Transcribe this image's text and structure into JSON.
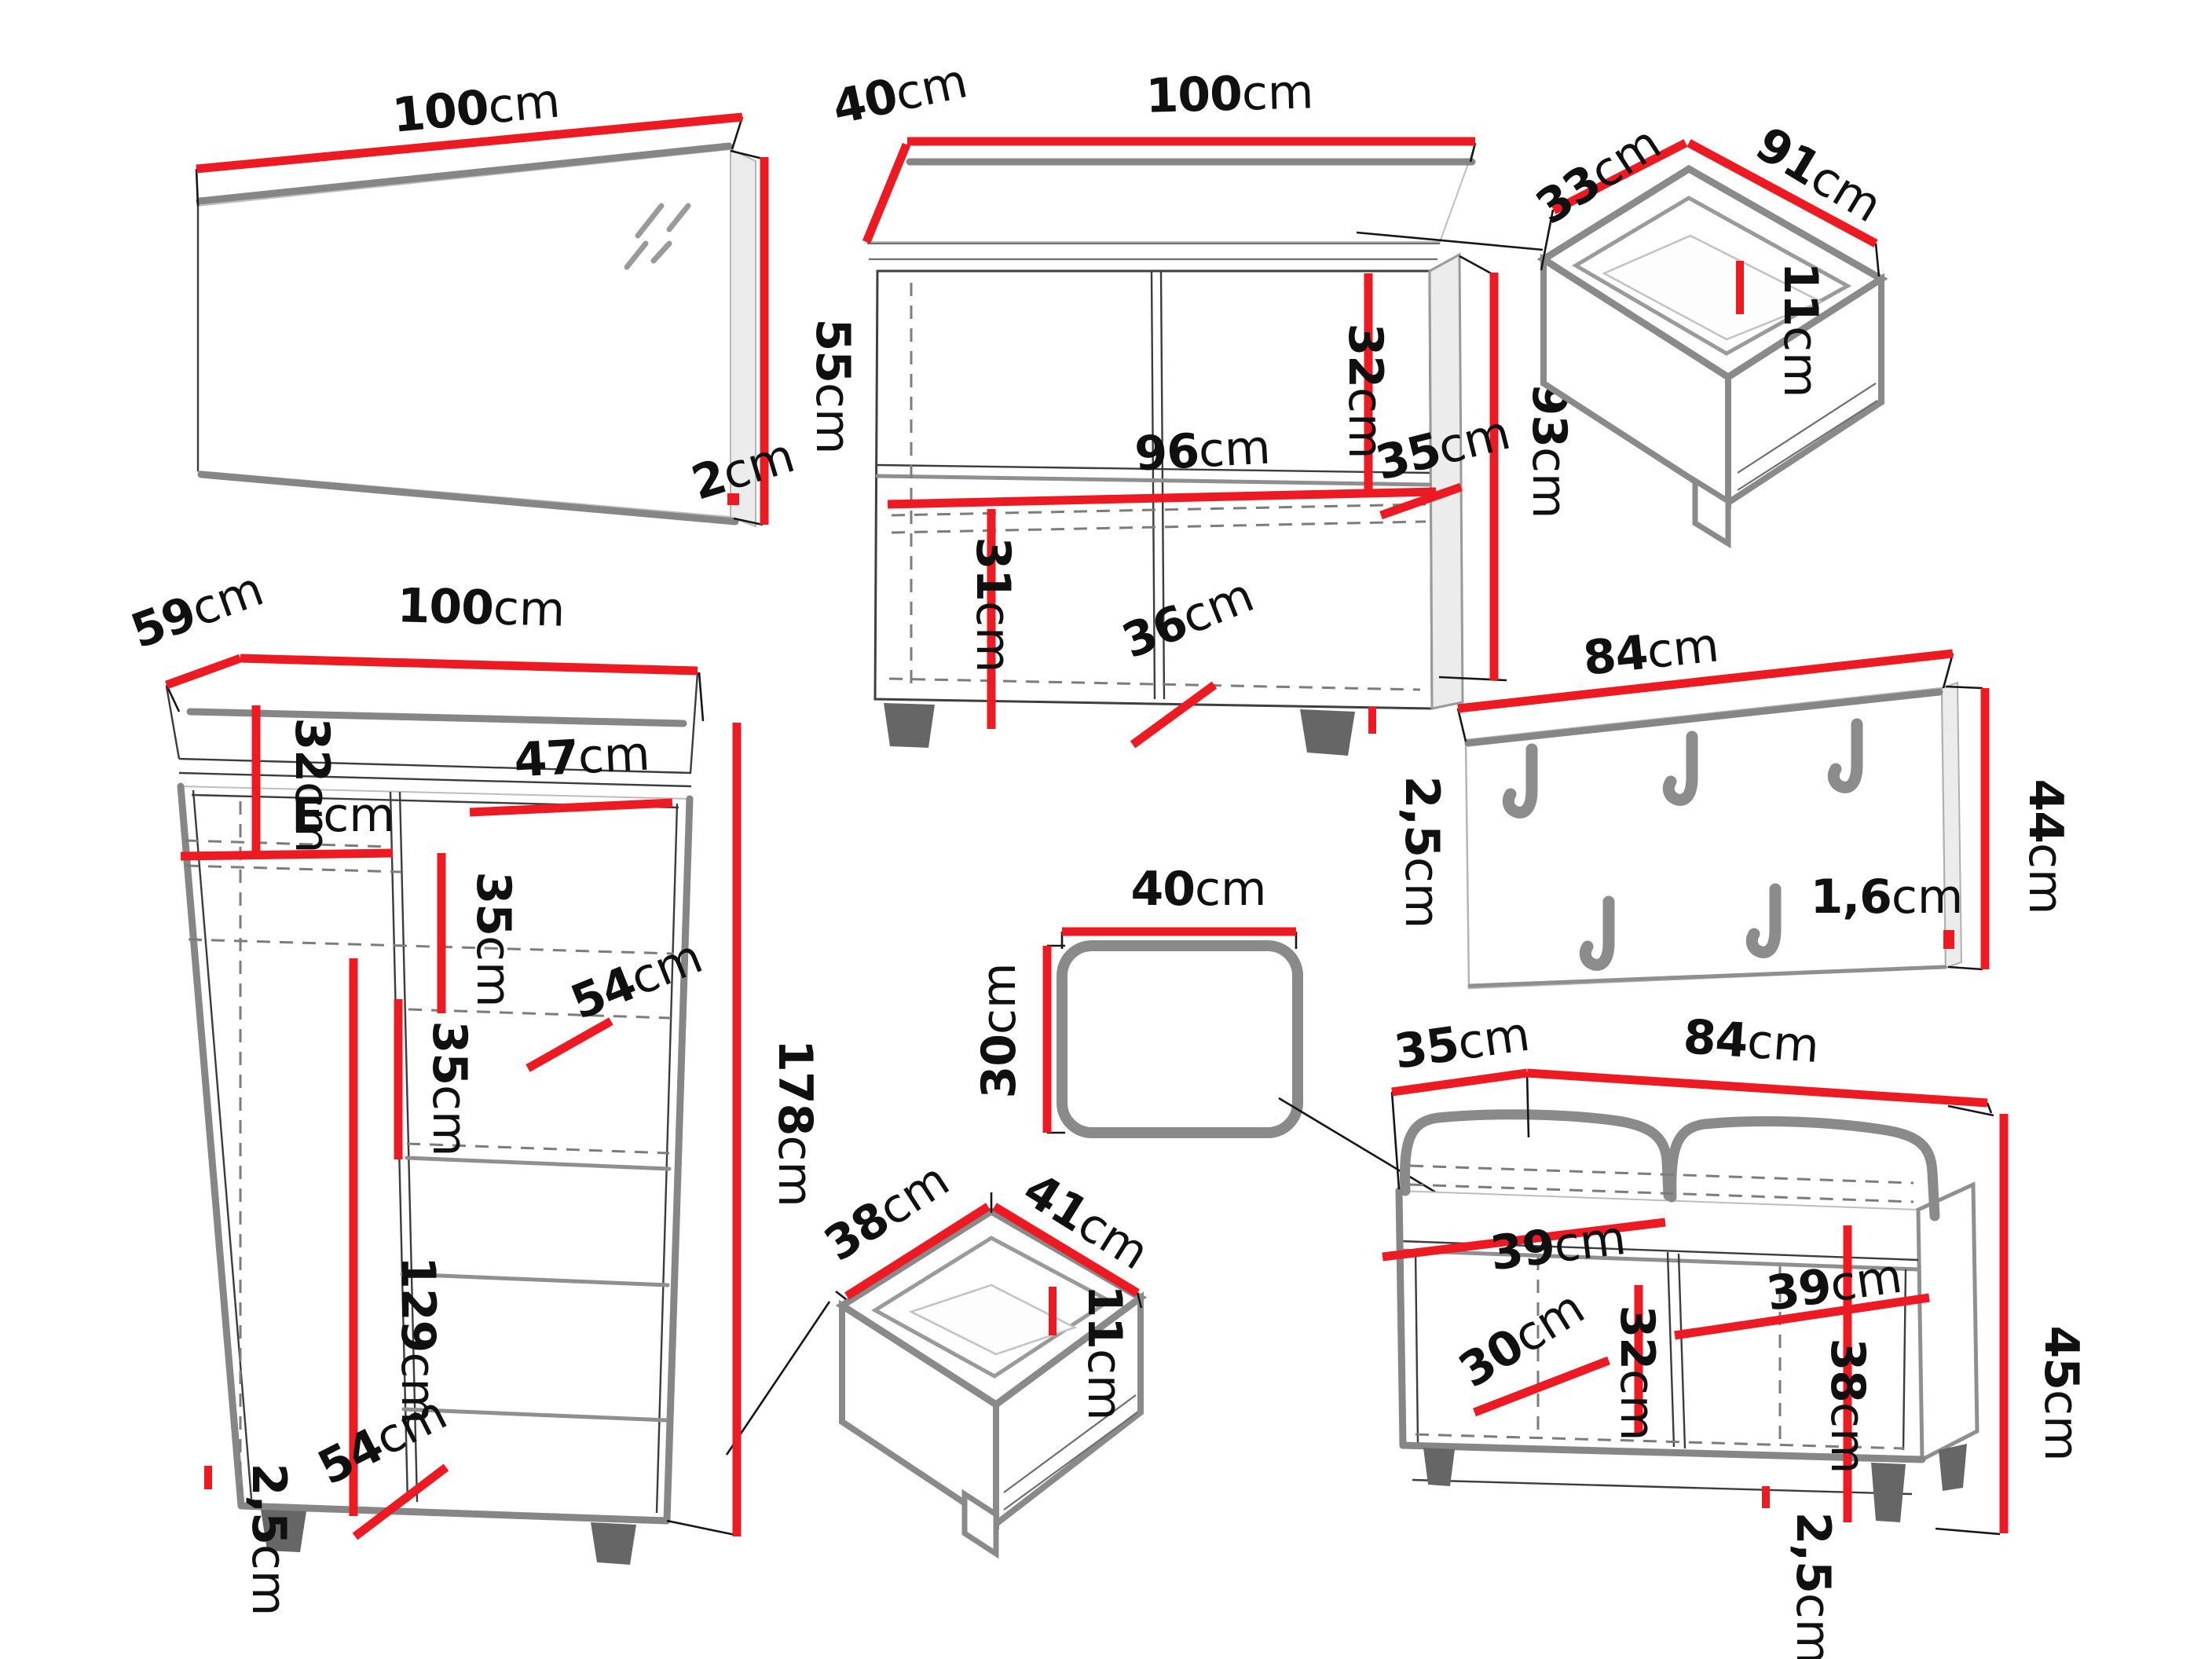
{
  "mirror": {
    "width": {
      "value": "100",
      "unit": "cm"
    },
    "height": {
      "value": "55",
      "unit": "cm"
    },
    "thickness": {
      "value": "2",
      "unit": "cm"
    }
  },
  "sideboard": {
    "depth": {
      "value": "40",
      "unit": "cm"
    },
    "width": {
      "value": "100",
      "unit": "cm"
    },
    "upper_section": {
      "value": "32",
      "unit": "cm"
    },
    "height": {
      "value": "93",
      "unit": "cm"
    },
    "inner_width": {
      "value": "96",
      "unit": "cm"
    },
    "shelf_depth_right": {
      "value": "35",
      "unit": "cm"
    },
    "lower_section": {
      "value": "31",
      "unit": "cm"
    },
    "shelf_depth_bottom": {
      "value": "36",
      "unit": "cm"
    },
    "plinth": {
      "value": "2,5",
      "unit": "cm"
    }
  },
  "drawer_large": {
    "depth": {
      "value": "33",
      "unit": "cm"
    },
    "width": {
      "value": "91",
      "unit": "cm"
    },
    "height": {
      "value": "11",
      "unit": "cm"
    }
  },
  "coat_rack": {
    "width": {
      "value": "84",
      "unit": "cm"
    },
    "height": {
      "value": "44",
      "unit": "cm"
    },
    "thickness": {
      "value": "1,6",
      "unit": "cm"
    }
  },
  "wardrobe": {
    "depth": {
      "value": "59",
      "unit": "cm"
    },
    "width": {
      "value": "100",
      "unit": "cm"
    },
    "upper_left_section": {
      "value": "32",
      "unit": "cm"
    },
    "left_shelf_width": {
      "value": "E",
      "unit": "cm"
    },
    "right_shelf_width": {
      "value": "47",
      "unit": "cm"
    },
    "shelf_gap_upper": {
      "value": "35",
      "unit": "cm"
    },
    "shelf_depth_upper": {
      "value": "54",
      "unit": "cm"
    },
    "shelf_gap_lower": {
      "value": "35",
      "unit": "cm"
    },
    "lower_section": {
      "value": "129",
      "unit": "cm"
    },
    "shelf_depth_lower": {
      "value": "54",
      "unit": "cm"
    },
    "plinth": {
      "value": "2,5",
      "unit": "cm"
    },
    "height": {
      "value": "178",
      "unit": "cm"
    }
  },
  "cushion": {
    "width": {
      "value": "40",
      "unit": "cm"
    },
    "height": {
      "value": "30",
      "unit": "cm"
    }
  },
  "drawer_small": {
    "depth": {
      "value": "38",
      "unit": "cm"
    },
    "width": {
      "value": "41",
      "unit": "cm"
    },
    "height": {
      "value": "11",
      "unit": "cm"
    }
  },
  "bench": {
    "depth": {
      "value": "35",
      "unit": "cm"
    },
    "width": {
      "value": "84",
      "unit": "cm"
    },
    "left_opening": {
      "value": "39",
      "unit": "cm"
    },
    "right_opening": {
      "value": "39",
      "unit": "cm"
    },
    "opening_height": {
      "value": "38",
      "unit": "cm"
    },
    "inner_height": {
      "value": "32",
      "unit": "cm"
    },
    "inner_depth": {
      "value": "30",
      "unit": "cm"
    },
    "height": {
      "value": "45",
      "unit": "cm"
    },
    "plinth": {
      "value": "2,5",
      "unit": "cm"
    }
  }
}
